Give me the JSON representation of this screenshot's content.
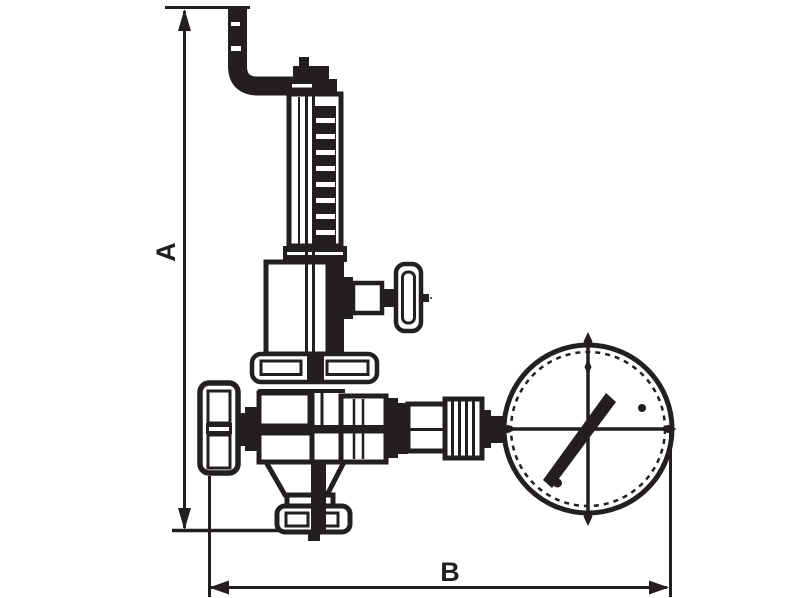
{
  "drawing": {
    "type": "dimensioned technical line drawing",
    "subject": "safety relief valve with top discharge pipe, side test valve, handwheel and pressure gauge",
    "ink_color": "#231f20",
    "background_color": "#ffffff",
    "dimensions": {
      "vertical": {
        "label": "A"
      },
      "horizontal": {
        "label": "B"
      }
    },
    "parts": [
      "discharge pipe",
      "adjusting cap",
      "spring bonnet",
      "coil spring",
      "bonnet housing",
      "test valve",
      "gland flange",
      "valve body",
      "handwheel",
      "inlet flange",
      "gauge union",
      "pressure gauge",
      "gauge needle"
    ]
  }
}
